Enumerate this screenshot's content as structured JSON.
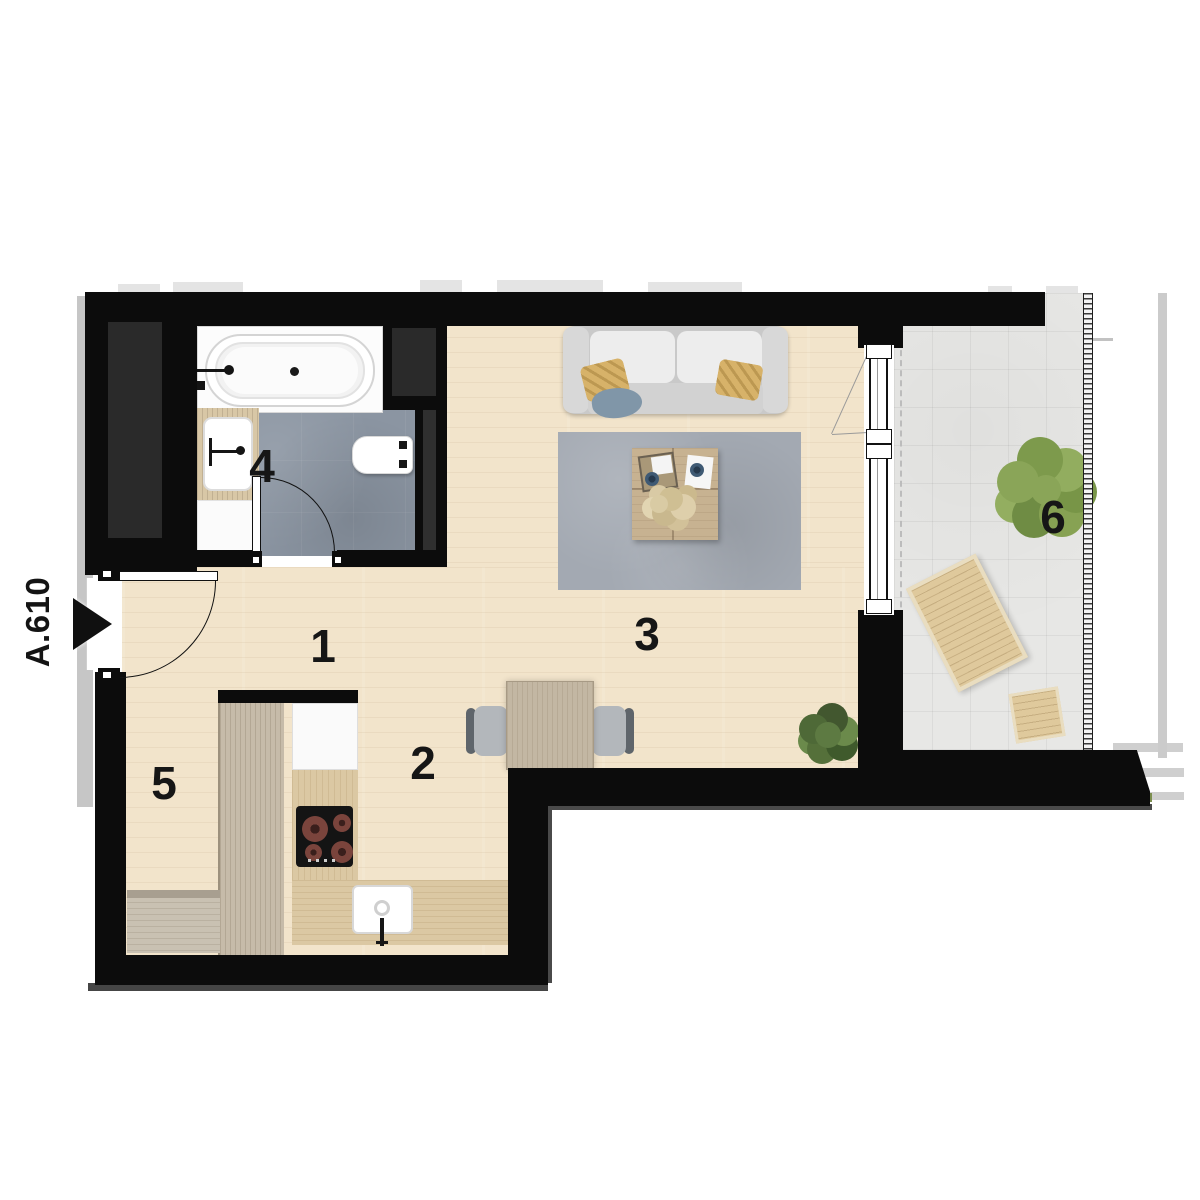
{
  "unit": {
    "label": "A.610"
  },
  "rooms": [
    {
      "id": "hall",
      "number": "1"
    },
    {
      "id": "kitchen",
      "number": "2"
    },
    {
      "id": "living-room",
      "number": "3"
    },
    {
      "id": "bathroom",
      "number": "4"
    },
    {
      "id": "wardrobe",
      "number": "5"
    },
    {
      "id": "balcony",
      "number": "6"
    }
  ],
  "colors": {
    "wall": "#0c0c0c",
    "wood_floor": "#f2e4cb",
    "bathroom_tile": "#8b95a2",
    "balcony_tile": "#e7e7e5",
    "rug": "#a3a9b2",
    "pillow_accent": "#d7b269",
    "plant_green": "#7d9551"
  }
}
